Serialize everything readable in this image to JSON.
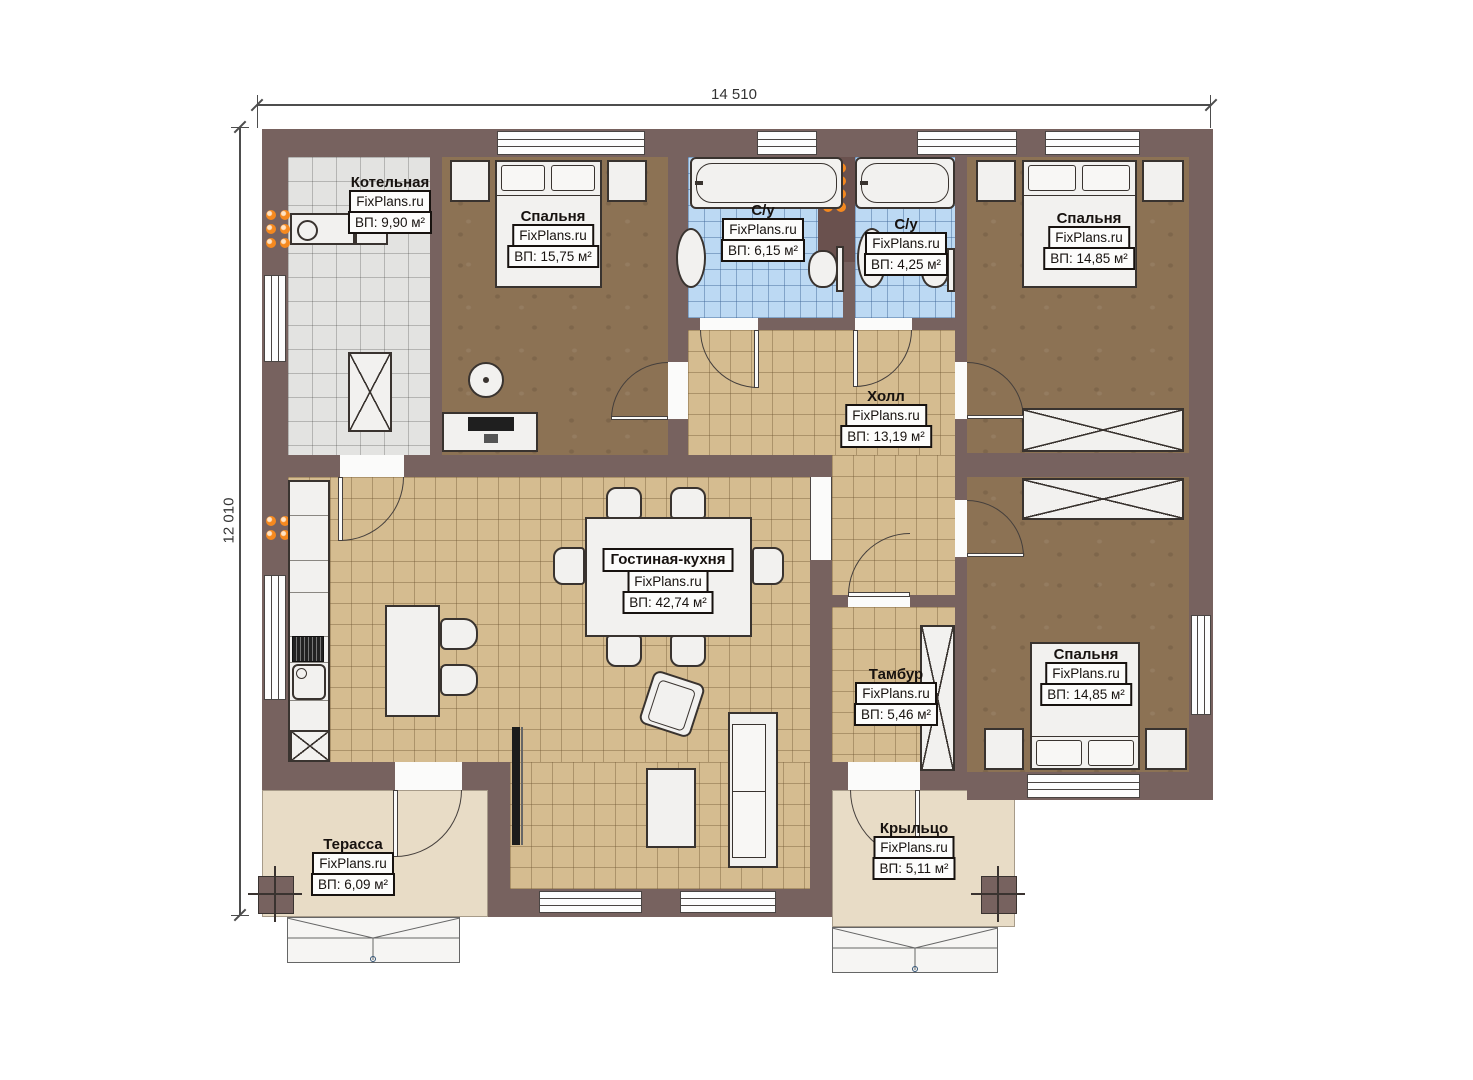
{
  "plan": {
    "width_label": "14 510",
    "height_label": "12 010",
    "watermark": "FixPlans.ru",
    "rooms": {
      "boiler": {
        "name": "Котельная",
        "area": "ВП: 9,90 м²"
      },
      "bedroom1": {
        "name": "Спальня",
        "area": "ВП: 15,75 м²"
      },
      "bath1": {
        "name": "С/у",
        "area": "ВП: 6,15 м²"
      },
      "bath2": {
        "name": "С/у",
        "area": "ВП: 4,25 м²"
      },
      "bedroom2": {
        "name": "Спальня",
        "area": "ВП: 14,85 м²"
      },
      "hall": {
        "name": "Холл",
        "area": "ВП: 13,19 м²"
      },
      "living": {
        "name": "Гостиная-кухня",
        "area": "ВП: 42,74 м²"
      },
      "tambour": {
        "name": "Тамбур",
        "area": "ВП: 5,46 м²"
      },
      "bedroom3": {
        "name": "Спальня",
        "area": "ВП: 14,85 м²"
      },
      "terrace": {
        "name": "Терасса",
        "area": "ВП: 6,09 м²"
      },
      "porch": {
        "name": "Крыльцо",
        "area": "ВП: 5,11 м²"
      }
    },
    "colors": {
      "wall": "#77625f",
      "floor_tile_tan": "#d5bc90",
      "floor_tile_blue": "#bcd9f3",
      "floor_tile_gray": "#e3e3e1",
      "floor_wood_brown": "#8c7254",
      "outdoor_beige": "#e8dcc6",
      "radiator_orange": "#f5891f"
    }
  }
}
